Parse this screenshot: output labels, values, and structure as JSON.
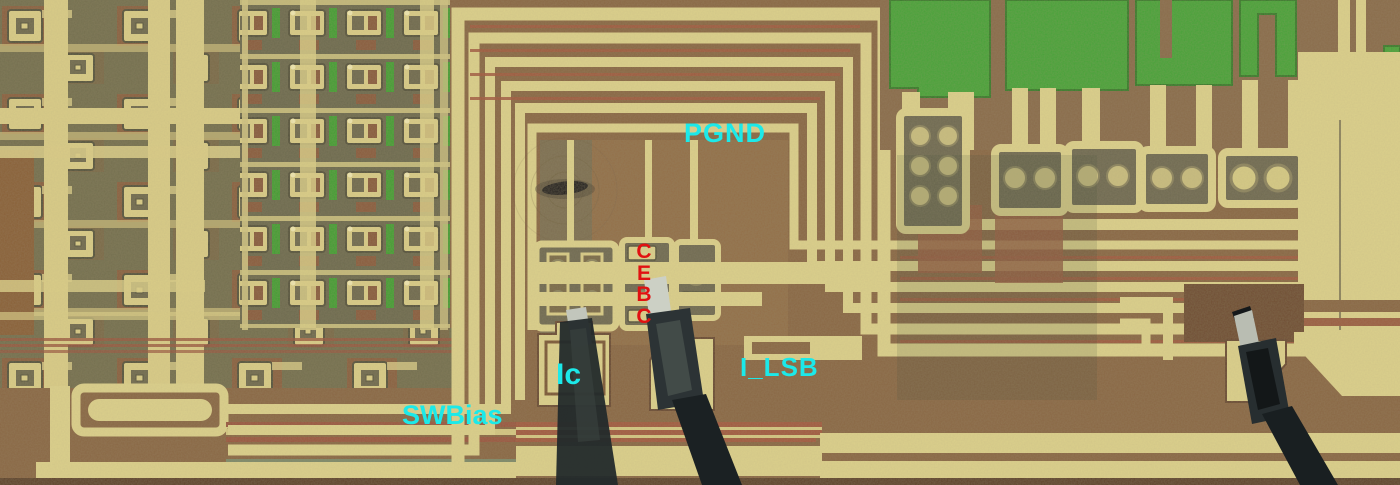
{
  "die_labels": {
    "pgnd": "PGND",
    "ic": "Ic",
    "i_lsb": "I_LSB",
    "swbias": "SWBias",
    "terminals": [
      "C",
      "E",
      "B",
      "C"
    ]
  },
  "colors": {
    "label-cyan": "#1ce9e9",
    "label-red": "#e11111",
    "metal-yellow": "#dcd08c",
    "substrate-brown": "#8a6745",
    "oxide-olive": "#74704f",
    "resistor-green": "#44a337",
    "rust-stripe": "#9a5640",
    "needle-dark": "#20272a"
  }
}
